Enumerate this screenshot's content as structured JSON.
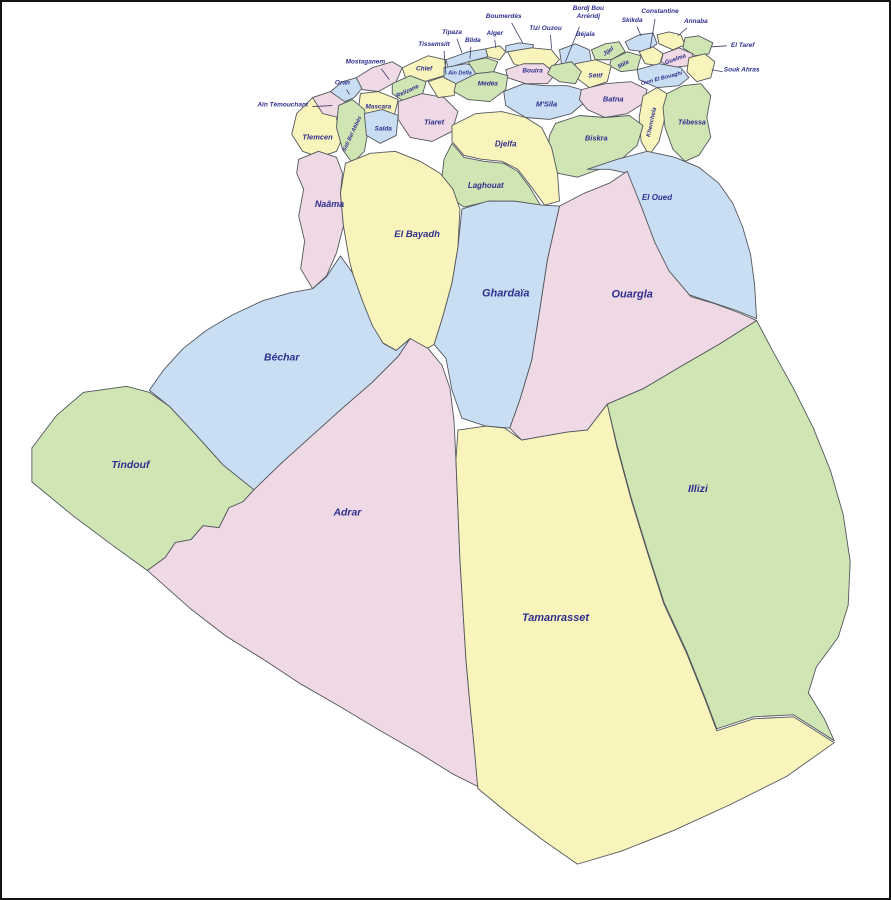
{
  "map": {
    "kind": "administrative-map",
    "country": "Algeria",
    "canvas": {
      "width": 891,
      "height": 900
    },
    "palette": {
      "yellow": "#f9f4bb",
      "green": "#cfe5b4",
      "blue": "#c9def3",
      "pink": "#eed9e4",
      "border": "#53565c",
      "leader": "#3c3f66",
      "label": "#2f2f8f",
      "background": "#ffffff"
    },
    "provinces": [
      {
        "name": "Tlemcen",
        "color": "yellow",
        "path": "M296,112 L312,96 L330,90 L340,100 L336,118 L344,132 L336,150 L318,156 L302,150 L291,133 Z",
        "label": {
          "x": 317,
          "y": 138,
          "size": 7.5
        }
      },
      {
        "name": "Aïn Témouchant",
        "color": "pink",
        "path": "M312,96 L330,90 L344,94 L348,106 L338,116 L322,112 Z",
        "label": {
          "x": 282,
          "y": 105,
          "size": 6.5
        },
        "leader": [
          312,
          105,
          332,
          104
        ]
      },
      {
        "name": "Oran",
        "color": "blue",
        "path": "M330,90 L342,80 L356,76 L362,86 L354,96 L344,100 Z",
        "label": {
          "x": 342,
          "y": 83,
          "size": 6.5
        },
        "leader": [
          346,
          88,
          349,
          93
        ]
      },
      {
        "name": "Mostaganem",
        "color": "pink",
        "path": "M356,76 L372,66 L392,60 L402,66 L396,80 L378,90 L362,88 Z",
        "label": {
          "x": 365,
          "y": 62,
          "size": 6.5
        },
        "leader": [
          381,
          67,
          389,
          78
        ]
      },
      {
        "name": "Chlef",
        "color": "yellow",
        "path": "M402,66 L428,54 L446,58 L444,74 L424,80 L406,78 Z",
        "label": {
          "x": 424,
          "y": 69,
          "size": 6.5
        }
      },
      {
        "name": "Relizane",
        "color": "green",
        "path": "M392,82 L410,74 L426,80 L422,94 L404,100 L392,92 Z",
        "label": {
          "x": 408,
          "y": 91,
          "size": 6,
          "rotate": -25
        }
      },
      {
        "name": "Mascara",
        "color": "yellow",
        "path": "M360,92 L378,90 L398,98 L394,114 L374,118 L358,108 Z",
        "label": {
          "x": 378,
          "y": 107,
          "size": 6.5
        }
      },
      {
        "name": "Sidi Bel Abbès",
        "color": "green",
        "path": "M338,104 L352,98 L364,108 L368,128 L364,150 L352,162 L342,148 L336,126 Z",
        "label": {
          "x": 353,
          "y": 133,
          "size": 5.5,
          "rotate": -65
        }
      },
      {
        "name": "Saïda",
        "color": "blue",
        "path": "M364,112 L382,108 L398,114 L396,134 L380,142 L366,134 Z",
        "label": {
          "x": 383,
          "y": 129,
          "size": 6.5
        }
      },
      {
        "name": "Tiaret",
        "color": "pink",
        "path": "M398,100 L422,92 L444,96 L458,110 L452,130 L432,140 L410,136 L398,118 Z",
        "label": {
          "x": 434,
          "y": 123,
          "size": 7.5
        }
      },
      {
        "name": "Tissemsilt",
        "color": "yellow",
        "path": "M428,80 L446,74 L458,80 L454,94 L438,96 Z",
        "label": {
          "x": 434,
          "y": 44,
          "size": 6.5
        },
        "leader": [
          444,
          49,
          446,
          73
        ]
      },
      {
        "name": "Tipaza",
        "color": "blue",
        "path": "M446,58 L468,50 L486,47 L488,55 L468,60 L448,66 Z",
        "label": {
          "x": 452,
          "y": 32,
          "size": 6.5
        },
        "leader": [
          457,
          37,
          462,
          51
        ]
      },
      {
        "name": "Aïn Defla",
        "color": "blue",
        "path": "M444,66 L466,62 L480,66 L476,78 L456,82 L444,76 Z",
        "label": {
          "x": 460,
          "y": 73,
          "size": 5.5
        }
      },
      {
        "name": "Blida",
        "color": "green",
        "path": "M468,60 L486,56 L498,60 L494,70 L476,72 Z",
        "label": {
          "x": 473,
          "y": 40,
          "size": 6.5
        },
        "leader": [
          471,
          45,
          470,
          57
        ]
      },
      {
        "name": "Alger",
        "color": "yellow",
        "path": "M486,47 L500,44 L506,50 L500,58 L488,55 Z",
        "label": {
          "x": 495,
          "y": 33,
          "size": 6.5
        },
        "leader": [
          495,
          38,
          496,
          46
        ]
      },
      {
        "name": "Boumerdès",
        "color": "blue",
        "path": "M506,44 L520,41 L534,43 L532,50 L516,53 L506,50 Z",
        "label": {
          "x": 504,
          "y": 16,
          "size": 6.5
        },
        "leader": [
          512,
          21,
          523,
          41
        ]
      },
      {
        "name": "Tizi Ouzou",
        "color": "yellow",
        "path": "M508,50 L532,46 L552,48 L560,58 L552,66 L532,68 L514,62 Z",
        "label": {
          "x": 546,
          "y": 28,
          "size": 6.5
        },
        "leader": [
          551,
          33,
          552,
          47
        ]
      },
      {
        "name": "Bouira",
        "color": "pink",
        "path": "M506,68 L524,62 L544,62 L556,72 L548,82 L526,82 L508,76 Z",
        "label": {
          "x": 533,
          "y": 71,
          "size": 6.5
        }
      },
      {
        "name": "Médéa",
        "color": "green",
        "path": "M456,82 L476,72 L494,70 L508,74 L506,88 L490,100 L468,98 L454,90 Z",
        "label": {
          "x": 488,
          "y": 84,
          "size": 6.5
        }
      },
      {
        "name": "Béjaïa",
        "color": "blue",
        "path": "M560,48 L576,42 L590,48 L592,60 L578,68 L562,62 Z",
        "label": {
          "x": 586,
          "y": 34,
          "size": 6.5
        }
      },
      {
        "name": "Jijel",
        "color": "green",
        "path": "M592,48 L606,42 L620,40 L626,50 L612,58 L596,58 Z",
        "label": {
          "x": 610,
          "y": 51,
          "size": 6,
          "rotate": -35
        }
      },
      {
        "name": "Skikda",
        "color": "blue",
        "path": "M626,40 L640,33 L654,31 L658,42 L646,50 L630,48 Z",
        "label": {
          "x": 633,
          "y": 20,
          "size": 6.5
        },
        "leader": [
          638,
          25,
          642,
          34
        ]
      },
      {
        "name": "Annaba",
        "color": "yellow",
        "path": "M658,33 L670,30 L682,33 L686,43 L674,48 L660,42 Z",
        "label": {
          "x": 697,
          "y": 21,
          "size": 6.5
        },
        "leader": [
          688,
          26,
          679,
          34
        ]
      },
      {
        "name": "El Taref",
        "color": "green",
        "path": "M686,36 L700,34 L714,41 L710,52 L696,54 L684,46 Z",
        "label": {
          "x": 744,
          "y": 45,
          "size": 6.5
        },
        "leader": [
          728,
          44,
          713,
          45
        ]
      },
      {
        "name": "Constantine",
        "color": "yellow",
        "path": "M640,50 L654,45 L664,52 L660,64 L646,62 Z",
        "label": {
          "x": 661,
          "y": 11,
          "size": 6.5
        },
        "leader": [
          656,
          17,
          651,
          47
        ]
      },
      {
        "name": "Guelma",
        "color": "pink",
        "path": "M664,52 L680,46 L694,52 L690,64 L672,66 L662,60 Z",
        "label": {
          "x": 677,
          "y": 59,
          "size": 6,
          "rotate": -20
        }
      },
      {
        "name": "Souk Ahras",
        "color": "yellow",
        "path": "M690,56 L706,52 L716,60 L712,76 L698,80 L688,70 Z",
        "label": {
          "x": 743,
          "y": 70,
          "size": 6.5
        },
        "leader": [
          724,
          70,
          713,
          68
        ]
      },
      {
        "name": "Mila",
        "color": "green",
        "path": "M612,58 L628,50 L642,54 L638,68 L622,70 L610,64 Z",
        "label": {
          "x": 625,
          "y": 64,
          "size": 6,
          "rotate": -30
        }
      },
      {
        "name": "Sétif",
        "color": "yellow",
        "path": "M576,62 L596,58 L612,64 L608,80 L590,86 L574,74 Z",
        "label": {
          "x": 596,
          "y": 76,
          "size": 6.5
        }
      },
      {
        "name": "Bordj Bou Arréridj",
        "color": "green",
        "path": "M552,64 L572,60 L582,70 L576,82 L560,80 L548,72 Z",
        "label": {
          "x": 589,
          "y": 8,
          "size": 6.5,
          "lines": [
            "Bordj Bou",
            "Arréridj"
          ]
        },
        "leader": [
          580,
          25,
          566,
          60
        ]
      },
      {
        "name": "Oum El Bouaghi",
        "color": "blue",
        "path": "M638,68 L660,62 L682,66 L690,76 L680,84 L658,86 L640,78 Z",
        "label": {
          "x": 663,
          "y": 78,
          "size": 5.5,
          "rotate": -15
        }
      },
      {
        "name": "M'Sila",
        "color": "blue",
        "path": "M504,90 L524,82 L546,84 L568,84 L582,88 L586,100 L572,112 L550,118 L526,116 L506,104 Z",
        "label": {
          "x": 547,
          "y": 105,
          "size": 7.5
        }
      },
      {
        "name": "Batna",
        "color": "pink",
        "path": "M582,88 L606,82 L632,80 L648,88 L644,102 L628,112 L606,116 L588,108 L580,98 Z",
        "label": {
          "x": 614,
          "y": 100,
          "size": 7.5
        }
      },
      {
        "name": "Khenchela",
        "color": "yellow",
        "path": "M644,94 L658,86 L668,92 L666,116 L660,140 L650,154 L642,140 L640,116 Z",
        "label": {
          "x": 654,
          "y": 121,
          "size": 6,
          "rotate": -78
        }
      },
      {
        "name": "Tébessa",
        "color": "green",
        "path": "M668,92 L684,84 L702,82 L712,94 L708,116 L712,136 L700,154 L686,160 L674,148 L666,126 L664,106 Z",
        "label": {
          "x": 693,
          "y": 123,
          "size": 7
        }
      },
      {
        "name": "Biskra",
        "color": "green",
        "path": "M556,122 L580,114 L606,116 L630,114 L644,124 L638,144 L622,158 L600,168 L578,176 L558,172 L548,152 L550,134 Z",
        "label": {
          "x": 597,
          "y": 139,
          "size": 7.5
        }
      },
      {
        "name": "Djelfa",
        "color": "yellow",
        "path": "M452,124 L476,112 L502,110 L526,116 L542,126 L552,146 L558,172 L560,200 L545,204 L532,186 L518,168 L502,160 L482,158 L464,154 L452,140 Z",
        "label": {
          "x": 506,
          "y": 145,
          "size": 8
        }
      },
      {
        "name": "Laghouat",
        "color": "green",
        "path": "M452,142 L464,156 L484,160 L504,162 L518,170 L530,186 L542,206 L518,202 L490,200 L464,206 L450,196 L442,176 L444,158 Z",
        "label": {
          "x": 486,
          "y": 187,
          "size": 8
        }
      },
      {
        "name": "El Oued",
        "color": "blue",
        "path": "M588,168 L618,158 L648,150 L676,156 L700,166 L720,182 L734,202 L744,226 L752,254 L756,284 L758,318 L738,310 L714,302 L690,294 L668,268 L654,240 L640,206 L628,172 L610,168 Z",
        "label": {
          "x": 658,
          "y": 199,
          "size": 8
        }
      },
      {
        "name": "Ouargla",
        "color": "pink",
        "path": "M560,205 L585,192 L610,182 L628,170 L642,205 L656,242 L670,270 L692,296 L716,303 L740,312 L758,320 L720,344 L682,366 L645,388 L608,404 L588,430 L568,432 L545,436 L522,440 L510,428 L520,400 L532,360 L540,310 L548,258 Z",
        "label": {
          "x": 633,
          "y": 297,
          "size": 11
        }
      },
      {
        "name": "Ghardaïa",
        "color": "blue",
        "path": "M462,208 L488,200 L515,200 L542,204 L560,205 L548,258 L540,310 L532,360 L520,400 L510,428 L486,426 L462,418 L452,390 L446,358 L434,344 L443,315 L452,282 L458,246 Z",
        "label": {
          "x": 506,
          "y": 296,
          "size": 11
        }
      },
      {
        "name": "Naâma",
        "color": "pink",
        "path": "M298,158 L318,150 L336,156 L342,172 L340,192 L343,225 L336,252 L326,275 L312,288 L300,268 L304,240 L298,215 L303,188 L296,172 Z",
        "label": {
          "x": 329,
          "y": 206,
          "size": 9
        }
      },
      {
        "name": "El Bayadh",
        "color": "yellow",
        "path": "M345,162 L370,152 L395,150 L420,160 L440,172 L453,188 L460,208 L458,246 L452,282 L443,315 L434,344 L420,352 L410,338 L396,350 L382,342 L370,325 L358,295 L349,260 L343,225 L340,192 Z",
        "label": {
          "x": 417,
          "y": 236,
          "size": 9.5
        }
      },
      {
        "name": "Béchar",
        "color": "blue",
        "path": "M148,390 L162,370 L182,348 L205,330 L232,314 L262,300 L290,292 L312,288 L326,276 L340,255 L352,272 L362,300 L372,325 L383,343 L396,350 L410,338 L398,356 L372,382 L342,408 L312,435 L282,462 L253,490 L222,465 L195,435 L168,406 Z",
        "label": {
          "x": 281,
          "y": 360,
          "size": 10.5
        }
      },
      {
        "name": "Tindouf",
        "color": "green",
        "path": "M82,392 L125,386 L148,392 L168,406 L195,435 L222,465 L253,490 L242,502 L228,508 L218,528 L202,526 L190,540 L174,543 L164,558 L146,571 L110,545 L70,515 L30,482 L30,448 L55,415 Z",
        "label": {
          "x": 129,
          "y": 468,
          "size": 10.5
        }
      },
      {
        "name": "Adrar",
        "color": "pink",
        "path": "M253,490 L282,462 L312,435 L342,408 L372,382 L398,356 L410,338 L428,348 L442,365 L450,388 L454,420 L456,460 L458,510 L460,560 L463,610 L466,660 L470,705 L474,745 L478,788 L452,775 L420,755 L380,732 L340,708 L300,685 L262,660 L225,637 L190,610 L146,571 L164,558 L174,543 L190,540 L202,526 L218,528 L228,508 L242,502 Z",
        "label": {
          "x": 347,
          "y": 516,
          "size": 10.5
        }
      },
      {
        "name": "Tamanrasset",
        "color": "yellow",
        "path": "M458,430 L486,426 L505,428 L522,440 L545,436 L568,432 L588,430 L608,404 L618,448 L632,500 L648,552 L665,605 L688,655 L706,700 L718,732 L755,720 L795,718 L836,744 L788,778 L732,806 L675,832 L622,853 L578,866 L545,843 L512,818 L478,790 L474,745 L470,705 L466,660 L463,610 L460,560 L458,510 L456,460 Z",
        "label": {
          "x": 556,
          "y": 622,
          "size": 11
        }
      },
      {
        "name": "Illizi",
        "color": "green",
        "path": "M608,404 L645,388 L682,366 L720,344 L758,320 L775,352 L795,388 L815,428 L832,470 L845,515 L852,562 L850,606 L840,638 L818,668 L810,694 L826,720 L836,742 L795,716 L755,718 L718,730 L706,698 L688,653 L665,603 L648,550 L632,498 L618,446 Z",
        "label": {
          "x": 699,
          "y": 492,
          "size": 10.5
        }
      }
    ]
  }
}
